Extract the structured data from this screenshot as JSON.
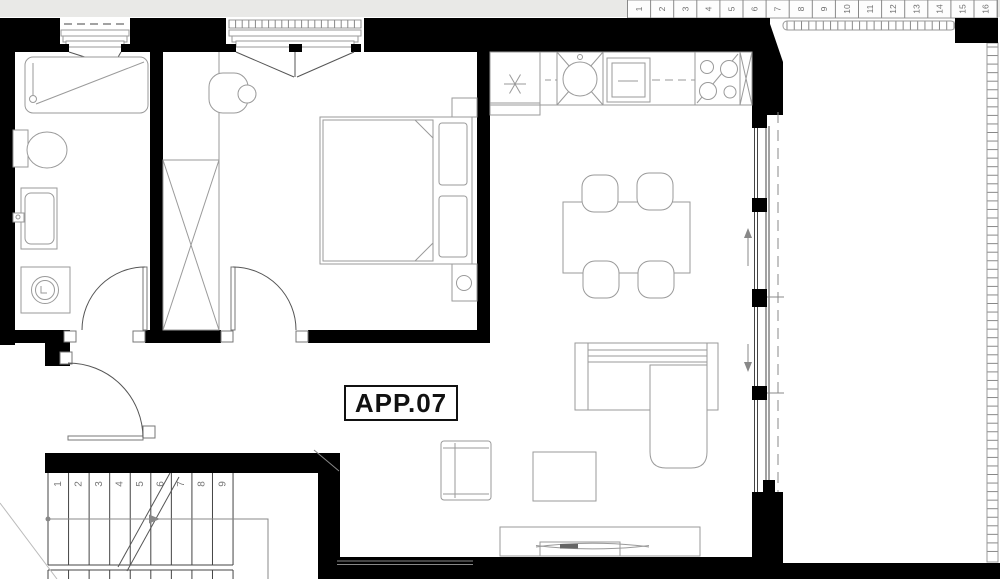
{
  "plan_label": {
    "text": "APP.07"
  },
  "upper_stair": {
    "numbers": [
      "1",
      "2",
      "3",
      "4",
      "5",
      "6",
      "7",
      "8",
      "9",
      "10",
      "11",
      "12",
      "13",
      "14",
      "15",
      "16"
    ]
  },
  "apartment_stair": {
    "numbers": [
      "1",
      "2",
      "3",
      "4",
      "5",
      "6",
      "7",
      "8",
      "9"
    ]
  },
  "colors": {
    "wall": "#000000",
    "background_gray": "#e9e9e7",
    "furniture_stroke": "#9a9a9a",
    "label_text": "#111111",
    "number_text": "#777777"
  }
}
